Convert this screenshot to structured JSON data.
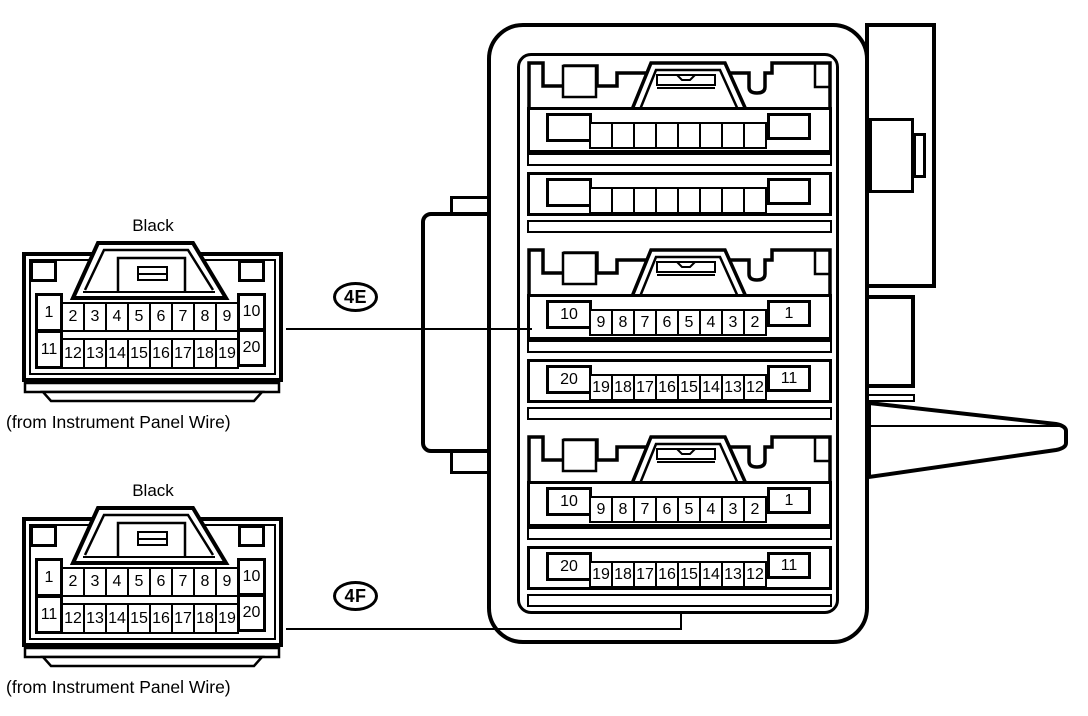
{
  "diagram": {
    "background": "#ffffff",
    "line_color": "#000000"
  },
  "left_connectors": [
    {
      "callout": "4E",
      "color": "Black",
      "caption": "(from Instrument Panel Wire)",
      "row1_left": "1",
      "row1_cells": [
        "2",
        "3",
        "4",
        "5",
        "6",
        "7",
        "8",
        "9"
      ],
      "row1_right": "10",
      "row2_left": "11",
      "row2_cells": [
        "12",
        "13",
        "14",
        "15",
        "16",
        "17",
        "18",
        "19"
      ],
      "row2_right": "20"
    },
    {
      "callout": "4F",
      "color": "Black",
      "caption": "(from Instrument Panel Wire)",
      "row1_left": "1",
      "row1_cells": [
        "2",
        "3",
        "4",
        "5",
        "6",
        "7",
        "8",
        "9"
      ],
      "row1_right": "10",
      "row2_left": "11",
      "row2_cells": [
        "12",
        "13",
        "14",
        "15",
        "16",
        "17",
        "18",
        "19"
      ],
      "row2_right": "20"
    }
  ],
  "right_block": {
    "sections": [
      {
        "row1_left": "",
        "row1_cells": [
          "",
          "",
          "",
          "",
          "",
          "",
          "",
          ""
        ],
        "row1_right": "",
        "row2_left": "",
        "row2_cells": [
          "",
          "",
          "",
          "",
          "",
          "",
          "",
          ""
        ],
        "row2_right": ""
      },
      {
        "row1_left": "10",
        "row1_cells": [
          "9",
          "8",
          "7",
          "6",
          "5",
          "4",
          "3",
          "2"
        ],
        "row1_right": "1",
        "row2_left": "20",
        "row2_cells": [
          "19",
          "18",
          "17",
          "16",
          "15",
          "14",
          "13",
          "12"
        ],
        "row2_right": "11"
      },
      {
        "row1_left": "10",
        "row1_cells": [
          "9",
          "8",
          "7",
          "6",
          "5",
          "4",
          "3",
          "2"
        ],
        "row1_right": "1",
        "row2_left": "20",
        "row2_cells": [
          "19",
          "18",
          "17",
          "16",
          "15",
          "14",
          "13",
          "12"
        ],
        "row2_right": "11"
      }
    ]
  }
}
